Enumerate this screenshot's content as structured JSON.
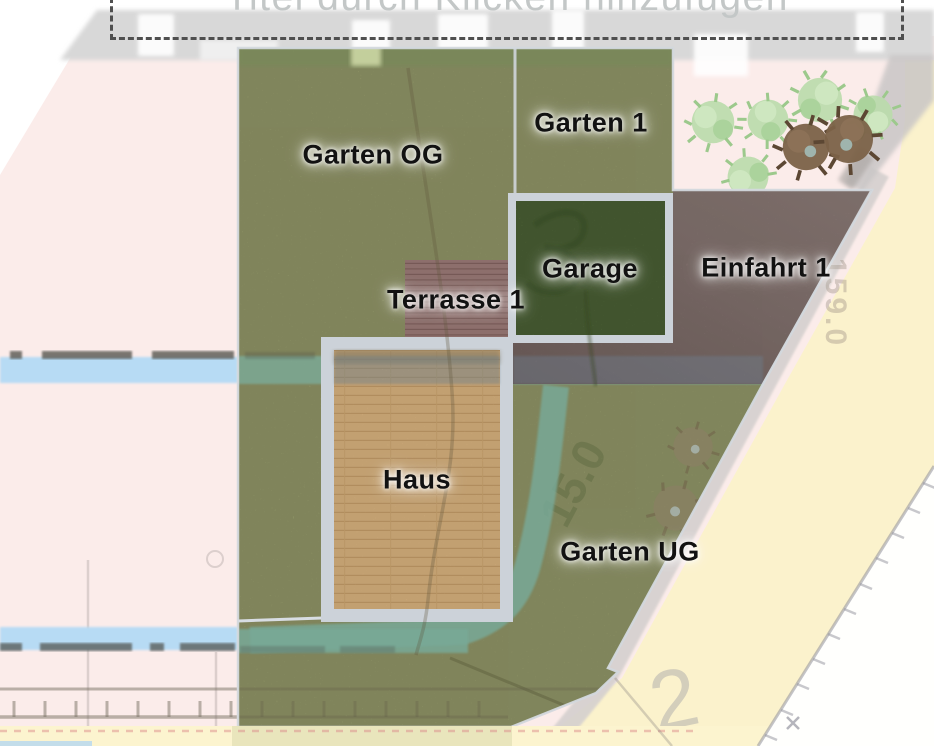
{
  "app": {
    "title_placeholder": "Titel durch Klicken hinzufügen"
  },
  "zones": {
    "garten_og": {
      "label": "Garten OG"
    },
    "garten_1": {
      "label": "Garten 1"
    },
    "garage": {
      "label": "Garage"
    },
    "einfahrt_1": {
      "label": "Einfahrt 1"
    },
    "terrasse_1": {
      "label": "Terrasse 1"
    },
    "haus": {
      "label": "Haus"
    },
    "garten_ug": {
      "label": "Garten UG"
    }
  },
  "map_annotations": {
    "measure_right": "159.0",
    "measure_garden": "15.0",
    "parcel_number": "2"
  },
  "plants": {
    "light_green_bushes": 5,
    "dark_brown_bushes": 2,
    "faded_bushes_in_garden": 2
  },
  "colors": {
    "grass": "#a5ab76",
    "garage_green": "#5e7943",
    "house_wood": "#d9b37f",
    "terrace_deck": "#8d6f6c",
    "driveway": "#8e7c78",
    "zone_border_gray": "#ccd2d9",
    "map_pink": "#fbecea",
    "map_yellow": "#fbf2cc",
    "stream_blue": "#b7dbf4",
    "stream_teal": "#7cab99",
    "title_text": "#c3c7c7"
  }
}
